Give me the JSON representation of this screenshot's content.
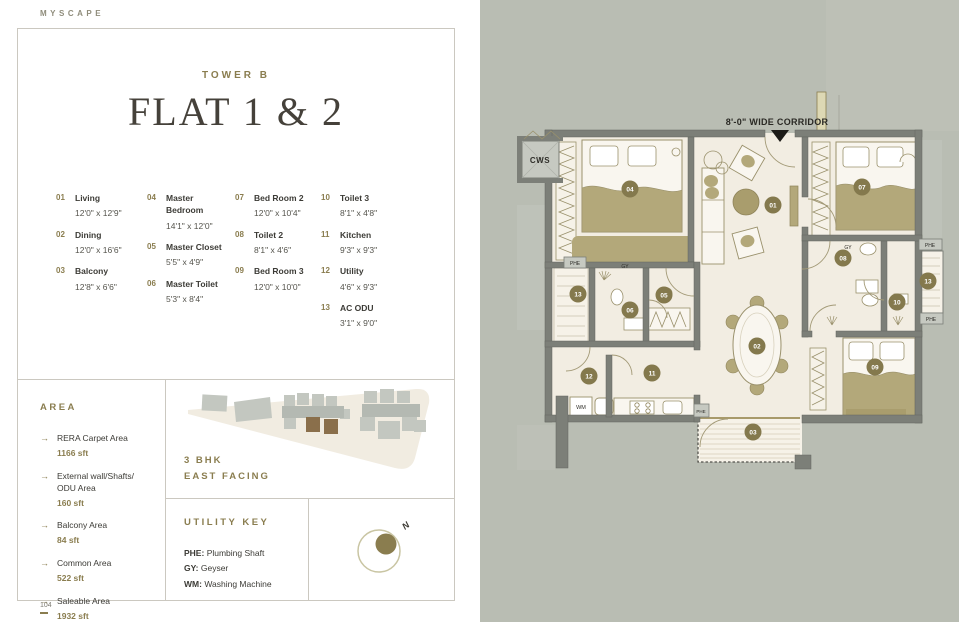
{
  "brand": "MYSCAPE",
  "page_number": "104",
  "header": {
    "tower": "TOWER B",
    "title": "FLAT 1 & 2"
  },
  "legend": {
    "columns": [
      {
        "items": [
          {
            "num": "01",
            "name": "Living",
            "dim": "12'0\" x 12'9\""
          },
          {
            "num": "02",
            "name": "Dining",
            "dim": "12'0\" x 16'6\""
          },
          {
            "num": "03",
            "name": "Balcony",
            "dim": "12'8\" x 6'6\""
          }
        ]
      },
      {
        "items": [
          {
            "num": "04",
            "name": "Master Bedroom",
            "dim": "14'1\" x 12'0\""
          },
          {
            "num": "05",
            "name": "Master Closet",
            "dim": "5'5\" x 4'9\""
          },
          {
            "num": "06",
            "name": "Master Toilet",
            "dim": "5'3\" x 8'4\""
          }
        ]
      },
      {
        "items": [
          {
            "num": "07",
            "name": "Bed Room 2",
            "dim": "12'0\" x 10'4\""
          },
          {
            "num": "08",
            "name": "Toilet 2",
            "dim": "8'1\" x 4'6\""
          },
          {
            "num": "09",
            "name": "Bed Room 3",
            "dim": "12'0\" x 10'0\""
          }
        ]
      },
      {
        "items": [
          {
            "num": "10",
            "name": "Toilet 3",
            "dim": "8'1\" x 4'8\""
          },
          {
            "num": "11",
            "name": "Kitchen",
            "dim": "9'3\" x 9'3\""
          },
          {
            "num": "12",
            "name": "Utility",
            "dim": "4'6\" x 9'3\""
          },
          {
            "num": "13",
            "name": "AC ODU",
            "dim": "3'1\" x 9'0\""
          }
        ]
      }
    ]
  },
  "area": {
    "heading": "AREA",
    "bullet": "→",
    "items": [
      {
        "label": "RERA Carpet Area",
        "value": "1166 sft"
      },
      {
        "label": "External wall/Shafts/ ODU Area",
        "value": "160 sft"
      },
      {
        "label": "Balcony Area",
        "value": "84 sft"
      },
      {
        "label": "Common Area",
        "value": "522 sft"
      },
      {
        "label": "Saleable Area",
        "value": "1932 sft"
      }
    ]
  },
  "sitemap": {
    "line1": "3 BHK",
    "line2": "EAST FACING"
  },
  "utility_key": {
    "heading": "UTILITY KEY",
    "items": [
      {
        "abbr": "PHE:",
        "label": "Plumbing Shaft"
      },
      {
        "abbr": "GY:",
        "label": "Geyser"
      },
      {
        "abbr": "WM:",
        "label": "Washing Machine"
      }
    ]
  },
  "compass": {
    "north": "N"
  },
  "plan": {
    "corridor_label": "8'-0\" WIDE CORRIDOR",
    "labels": {
      "cws": "CWS",
      "phe": "PHE",
      "gy": "GY",
      "wm": "WM"
    },
    "badges": [
      "01",
      "02",
      "03",
      "04",
      "05",
      "06",
      "07",
      "08",
      "09",
      "10",
      "11",
      "12",
      "13",
      "13"
    ],
    "colors": {
      "background": "#b9bdb3",
      "floor": "#f2ede2",
      "wall": "#7c7f78",
      "furniture_olive": "#b3a87a",
      "badge": "#84794d",
      "accent": "#8a7d4f"
    }
  }
}
